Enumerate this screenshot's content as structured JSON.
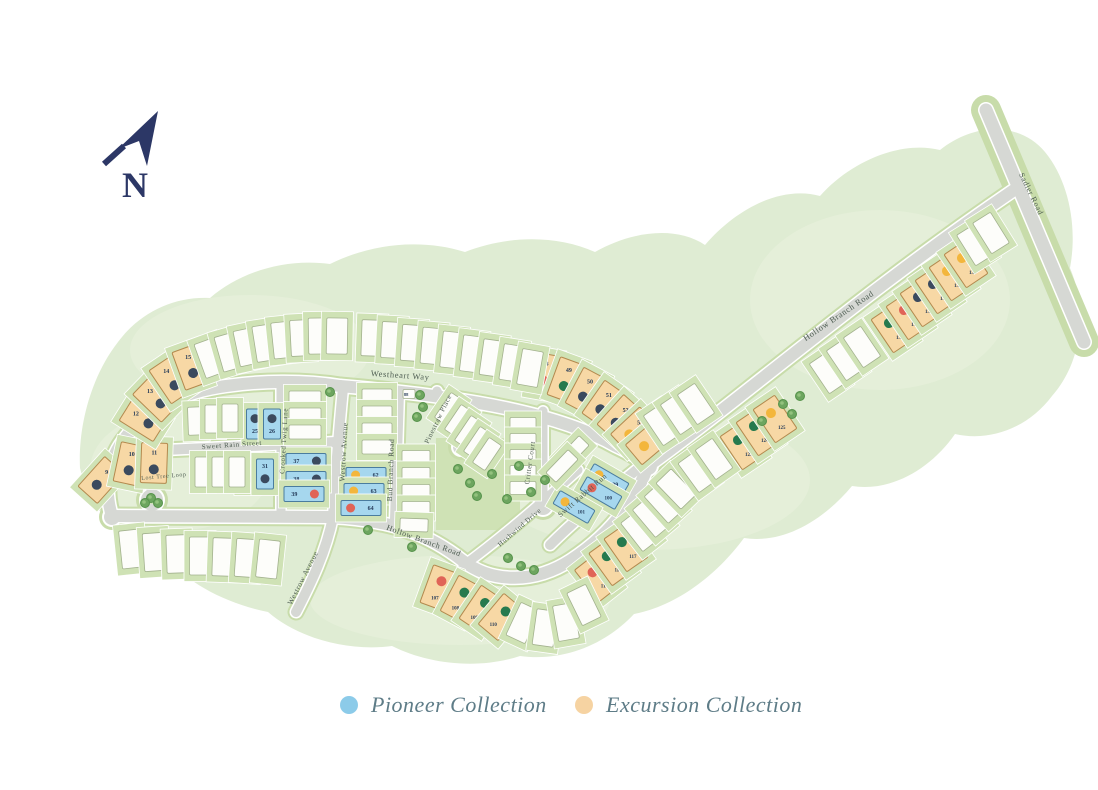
{
  "title": "Community Site Plan",
  "north": {
    "label": "N"
  },
  "legend": {
    "items": [
      {
        "label": "Pioneer Collection",
        "color": "#8ccbe9"
      },
      {
        "label": "Excursion Collection",
        "color": "#f6d3a2"
      }
    ]
  },
  "map": {
    "colors": {
      "blob": "#dfecd3",
      "blob_light": "#e9f3de",
      "verge": "#c8dcaa",
      "road": "#d6d8d4",
      "road_edge": "#ffffff",
      "yard": "#cfe2b5",
      "yard_stroke": "#ffffff",
      "lot_white": "#fdfdfa",
      "lot_white_stroke": "#a3b28e",
      "pioneer": "#a6d7ee",
      "pioneer_stroke": "#4a7c9e",
      "excursion": "#f7d8a5",
      "excursion_stroke": "#b3894e",
      "num": "#243a58",
      "street_text": "#4e5d52",
      "tree_outer": "#6da55f",
      "tree_inner": "#93c27e",
      "tree_stroke": "#55924a",
      "north": "#2c3766",
      "dots": {
        "navy": "#3b4a5e",
        "green": "#267a4e",
        "red": "#e06457",
        "yellow": "#f3b63c"
      }
    },
    "blob": "M80,468 C78,428 90,378 118,342 C140,312 175,296 210,298 C240,272 285,258 330,264 C370,244 420,238 465,252 C505,236 555,234 595,252 C630,232 675,225 705,245 C735,210 780,185 820,196 C850,162 900,140 940,150 C975,122 1020,122 1045,152 C1068,180 1078,225 1070,268 C1088,310 1082,362 1052,396 C1028,428 990,442 955,434 C930,470 890,492 852,486 C822,522 782,544 744,538 C716,576 676,606 634,614 C606,644 564,662 520,656 C478,670 428,664 392,646 C348,652 298,638 268,612 C228,604 188,584 168,558 C128,548 92,516 80,468 Z",
    "patches": [
      [
        250,
        350,
        120,
        55
      ],
      [
        650,
        480,
        160,
        70
      ],
      [
        880,
        300,
        130,
        90
      ],
      [
        460,
        600,
        150,
        45
      ],
      [
        180,
        470,
        90,
        60
      ]
    ],
    "panels": [
      [
        436,
        438,
        84,
        92
      ]
    ],
    "roads": [
      {
        "n": "outer-west",
        "d": "M112,516 C103,487 109,457 126,437 C147,409 182,392 226,386 C260,381 302,380 340,386",
        "w": 12
      },
      {
        "n": "westheart-way",
        "d": "M340,386 C470,397 560,414 616,446 C631,453 641,459 648,466",
        "w": 12
      },
      {
        "n": "hollow-branch-ne",
        "d": "M648,466 C740,400 860,295 1014,190",
        "w": 12
      },
      {
        "n": "sadler-road",
        "d": "M986,110 L1084,342",
        "w": 13,
        "c": 30
      },
      {
        "n": "hollow-branch-s",
        "d": "M112,516 L330,517 C396,520 431,536 463,561 C493,584 536,583 571,560 C606,537 633,506 648,466",
        "w": 12
      },
      {
        "n": "sweet-rain-street",
        "d": "M165,450 L336,442",
        "w": 10
      },
      {
        "n": "lost-tree-loop",
        "d": "M165,450 C153,461 149,476 151,490",
        "w": 9
      },
      {
        "n": "crooked-twig-lane",
        "d": "M281,384 L281,517",
        "w": 9
      },
      {
        "n": "westrow-avenue",
        "d": "M343,388 C338,440 335,480 333,517 C326,552 311,583 296,612",
        "w": 10
      },
      {
        "n": "bud-branch-road",
        "d": "M399,392 L395,520",
        "w": 10
      },
      {
        "n": "pinestraw-place",
        "d": "M437,391 L458,438",
        "w": 9
      },
      {
        "n": "critter-court",
        "d": "M543,411 L543,498",
        "w": 9
      },
      {
        "n": "swift-rabbit-run",
        "d": "M645,463 C612,490 578,517 550,545",
        "w": 10
      },
      {
        "n": "hushwind-drive",
        "d": "M463,566 C505,535 545,500 578,470",
        "w": 9
      }
    ],
    "bulbs": [
      [
        152,
        500,
        11
      ],
      [
        461,
        447,
        8
      ],
      [
        543,
        506,
        9
      ],
      [
        112,
        517,
        8
      ],
      [
        648,
        466,
        9
      ]
    ],
    "streets": [
      {
        "name": "Westheart Way",
        "x": 400,
        "y": 378,
        "r": 4,
        "s": 8.5
      },
      {
        "name": "Sweet Rain Street",
        "x": 232,
        "y": 447,
        "r": -4,
        "s": 7
      },
      {
        "name": "Lost Tree Loop",
        "x": 164,
        "y": 478,
        "r": -5,
        "s": 6
      },
      {
        "name": "Crooked Twig Lane",
        "x": 286,
        "y": 441,
        "r": -87,
        "s": 7
      },
      {
        "name": "Westrow Avenue",
        "x": 346,
        "y": 452,
        "r": -87,
        "s": 7.5
      },
      {
        "name": "Westrow Avenue",
        "x": 305,
        "y": 579,
        "r": -63,
        "s": 7.5
      },
      {
        "name": "Bud Branch Road",
        "x": 393,
        "y": 470,
        "r": -88,
        "s": 7.5
      },
      {
        "name": "Pinestraw Place",
        "x": 440,
        "y": 420,
        "r": -64,
        "s": 7
      },
      {
        "name": "Critter Court",
        "x": 532,
        "y": 463,
        "r": -82,
        "s": 7
      },
      {
        "name": "Swift Rabbit Run",
        "x": 584,
        "y": 497,
        "r": -41,
        "s": 7.5
      },
      {
        "name": "Hushwind Drive",
        "x": 521,
        "y": 529,
        "r": -41,
        "s": 7
      },
      {
        "name": "Hollow Branch Road",
        "x": 423,
        "y": 543,
        "r": 20,
        "s": 8
      },
      {
        "name": "Hollow Branch Road",
        "x": 840,
        "y": 318,
        "r": -34,
        "s": 8.5
      },
      {
        "name": "Sadler Road",
        "x": 1029,
        "y": 195,
        "r": 64,
        "s": 8
      }
    ],
    "trees": [
      [
        330,
        392
      ],
      [
        420,
        395
      ],
      [
        423,
        407
      ],
      [
        417,
        417
      ],
      [
        151,
        498
      ],
      [
        158,
        503
      ],
      [
        145,
        503
      ],
      [
        458,
        469
      ],
      [
        470,
        483
      ],
      [
        492,
        474
      ],
      [
        519,
        466
      ],
      [
        545,
        480
      ],
      [
        531,
        492
      ],
      [
        507,
        499
      ],
      [
        477,
        496
      ],
      [
        368,
        530
      ],
      [
        412,
        547
      ],
      [
        508,
        558
      ],
      [
        521,
        566
      ],
      [
        534,
        570
      ],
      [
        783,
        404
      ],
      [
        792,
        414
      ],
      [
        800,
        396
      ],
      [
        762,
        421
      ]
    ],
    "lots": [
      {
        "n": "9",
        "t": "e",
        "d": "navy",
        "x": 101,
        "y": 480,
        "r": 42
      },
      {
        "n": "10",
        "t": "e",
        "d": "navy",
        "x": 130,
        "y": 464,
        "r": 12
      },
      {
        "n": "11",
        "t": "e",
        "d": "navy",
        "x": 154,
        "y": 463,
        "r": 2
      },
      {
        "n": "12",
        "t": "e",
        "d": "navy",
        "x": 143,
        "y": 420,
        "r": -58
      },
      {
        "n": "13",
        "t": "e",
        "d": "navy",
        "x": 156,
        "y": 399,
        "r": -46
      },
      {
        "n": "14",
        "t": "e",
        "d": "navy",
        "x": 171,
        "y": 380,
        "r": -34
      },
      {
        "n": "15",
        "t": "e",
        "d": "navy",
        "x": 191,
        "y": 367,
        "r": -20
      },
      {
        "n": "25",
        "t": "p",
        "d": "navy",
        "x": 255,
        "y": 424,
        "f": 1
      },
      {
        "n": "26",
        "t": "p",
        "d": "navy",
        "x": 272,
        "y": 424,
        "f": 1
      },
      {
        "n": "30",
        "t": "p",
        "d": "navy",
        "x": 248,
        "y": 474
      },
      {
        "n": "31",
        "t": "p",
        "d": "navy",
        "x": 265,
        "y": 474
      },
      {
        "n": "37",
        "t": "p",
        "s": "l",
        "d": "navy",
        "x": 306,
        "y": 461
      },
      {
        "n": "38",
        "t": "p",
        "s": "l",
        "d": "navy",
        "x": 306,
        "y": 479
      },
      {
        "n": "39",
        "t": "p",
        "s": "l",
        "d": "red",
        "x": 304,
        "y": 494
      },
      {
        "n": "48",
        "t": "e",
        "d": "red",
        "x": 544,
        "y": 374,
        "r": 10
      },
      {
        "n": "49",
        "t": "e",
        "d": "green",
        "x": 566,
        "y": 380,
        "r": 20
      },
      {
        "n": "50",
        "t": "e",
        "d": "navy",
        "x": 586,
        "y": 391,
        "r": 28
      },
      {
        "n": "51",
        "t": "e",
        "d": "navy",
        "x": 604,
        "y": 404,
        "r": 35
      },
      {
        "n": "52",
        "t": "e",
        "d": "navy",
        "x": 620,
        "y": 418,
        "r": 42
      },
      {
        "n": "53",
        "t": "e",
        "d": "yellow",
        "x": 634,
        "y": 430,
        "r": 47
      },
      {
        "n": "54",
        "t": "e",
        "d": "yellow",
        "x": 649,
        "y": 442,
        "r": 50
      },
      {
        "n": "62",
        "t": "p",
        "s": "l",
        "d": "yellow",
        "x": 366,
        "y": 475,
        "f": 1
      },
      {
        "n": "63",
        "t": "p",
        "s": "l",
        "d": "yellow",
        "x": 364,
        "y": 491,
        "f": 1
      },
      {
        "n": "64",
        "t": "p",
        "s": "l",
        "d": "red",
        "x": 361,
        "y": 508,
        "f": 1
      },
      {
        "n": "88",
        "t": "w",
        "x": 409,
        "y": 394,
        "w": 12,
        "h": 9
      },
      {
        "n": "99",
        "t": "p",
        "s": "l",
        "d": "yellow",
        "x": 608,
        "y": 480,
        "r": 30,
        "f": 1
      },
      {
        "n": "100",
        "t": "p",
        "s": "l",
        "d": "red",
        "x": 601,
        "y": 493,
        "r": 30,
        "f": 1
      },
      {
        "n": "101",
        "t": "p",
        "s": "l",
        "d": "yellow",
        "x": 574,
        "y": 507,
        "r": 30,
        "f": 1
      },
      {
        "n": "107",
        "t": "e",
        "d": "red",
        "x": 439,
        "y": 588,
        "r": 20,
        "f": 1
      },
      {
        "n": "108",
        "t": "e",
        "d": "green",
        "x": 461,
        "y": 599,
        "r": 28,
        "f": 1
      },
      {
        "n": "109",
        "t": "e",
        "d": "green",
        "x": 481,
        "y": 609,
        "r": 34,
        "f": 1
      },
      {
        "n": "110",
        "t": "e",
        "d": "green",
        "x": 501,
        "y": 617,
        "r": 40,
        "f": 1
      },
      {
        "n": "115",
        "t": "e",
        "d": "red",
        "x": 597,
        "y": 578,
        "r": -38,
        "f": 1
      },
      {
        "n": "116",
        "t": "e",
        "d": "green",
        "x": 611,
        "y": 562,
        "r": -36,
        "f": 1
      },
      {
        "n": "117",
        "t": "e",
        "d": "green",
        "x": 626,
        "y": 548,
        "r": -35,
        "f": 1
      },
      {
        "n": "123",
        "t": "e",
        "d": "green",
        "x": 742,
        "y": 446,
        "r": -34,
        "f": 1
      },
      {
        "n": "124",
        "t": "e",
        "d": "green",
        "x": 758,
        "y": 432,
        "r": -34,
        "f": 1
      },
      {
        "n": "125",
        "t": "e",
        "d": "yellow",
        "x": 775,
        "y": 419,
        "r": -34,
        "f": 1
      },
      {
        "n": "131",
        "t": "e",
        "d": "green",
        "x": 893,
        "y": 329,
        "r": -34,
        "f": 1
      },
      {
        "n": "132",
        "t": "e",
        "d": "red",
        "x": 908,
        "y": 316,
        "r": -34,
        "f": 1
      },
      {
        "n": "133",
        "t": "e",
        "d": "navy",
        "x": 922,
        "y": 303,
        "r": -34,
        "f": 1
      },
      {
        "n": "134",
        "t": "e",
        "d": "navy",
        "x": 937,
        "y": 290,
        "r": -34,
        "f": 1
      },
      {
        "n": "135",
        "t": "e",
        "d": "yellow",
        "x": 951,
        "y": 277,
        "r": -34,
        "f": 1
      },
      {
        "n": "136",
        "t": "e",
        "d": "yellow",
        "x": 966,
        "y": 264,
        "r": -34,
        "f": 1
      },
      {
        "t": "w",
        "x": 210,
        "y": 358,
        "r": -20
      },
      {
        "t": "w",
        "x": 229,
        "y": 352,
        "r": -16
      },
      {
        "t": "w",
        "x": 247,
        "y": 347,
        "r": -12
      },
      {
        "t": "w",
        "x": 265,
        "y": 343,
        "r": -9
      },
      {
        "t": "w",
        "x": 283,
        "y": 340,
        "r": -6
      },
      {
        "t": "w",
        "x": 301,
        "y": 338,
        "r": -3
      },
      {
        "t": "w",
        "x": 319,
        "y": 336,
        "r": -1
      },
      {
        "t": "w",
        "x": 337,
        "y": 336,
        "r": 1
      },
      {
        "t": "w",
        "x": 372,
        "y": 338,
        "r": 2
      },
      {
        "t": "w",
        "x": 392,
        "y": 340,
        "r": 3
      },
      {
        "t": "w",
        "x": 412,
        "y": 343,
        "r": 4
      },
      {
        "t": "w",
        "x": 432,
        "y": 346,
        "r": 5
      },
      {
        "t": "w",
        "x": 452,
        "y": 350,
        "r": 6
      },
      {
        "t": "w",
        "x": 472,
        "y": 354,
        "r": 7
      },
      {
        "t": "w",
        "x": 492,
        "y": 358,
        "r": 8
      },
      {
        "t": "w",
        "x": 512,
        "y": 363,
        "r": 9
      },
      {
        "t": "w",
        "x": 530,
        "y": 368,
        "r": 10
      },
      {
        "t": "w",
        "x": 196,
        "y": 421,
        "r": -2,
        "w": 16,
        "h": 28
      },
      {
        "t": "w",
        "x": 213,
        "y": 419,
        "w": 16,
        "h": 28
      },
      {
        "t": "w",
        "x": 230,
        "y": 418,
        "w": 16,
        "h": 28
      },
      {
        "t": "w",
        "x": 203,
        "y": 472,
        "w": 16,
        "h": 30
      },
      {
        "t": "w",
        "x": 220,
        "y": 472,
        "w": 16,
        "h": 30
      },
      {
        "t": "w",
        "x": 237,
        "y": 472,
        "w": 16,
        "h": 30
      },
      {
        "t": "w",
        "x": 305,
        "y": 398,
        "w": 32,
        "h": 14
      },
      {
        "t": "w",
        "x": 305,
        "y": 415,
        "w": 32,
        "h": 14
      },
      {
        "t": "w",
        "x": 305,
        "y": 432,
        "w": 32,
        "h": 14
      },
      {
        "t": "w",
        "x": 377,
        "y": 396,
        "w": 30,
        "h": 14
      },
      {
        "t": "w",
        "x": 377,
        "y": 413,
        "w": 30,
        "h": 14
      },
      {
        "t": "w",
        "x": 377,
        "y": 430,
        "w": 30,
        "h": 14
      },
      {
        "t": "w",
        "x": 377,
        "y": 447,
        "w": 30,
        "h": 14
      },
      {
        "t": "w",
        "x": 416,
        "y": 457,
        "w": 28,
        "h": 13
      },
      {
        "t": "w",
        "x": 416,
        "y": 474,
        "w": 28,
        "h": 13
      },
      {
        "t": "w",
        "x": 416,
        "y": 491,
        "w": 28,
        "h": 13
      },
      {
        "t": "w",
        "x": 416,
        "y": 508,
        "w": 28,
        "h": 13
      },
      {
        "t": "w",
        "x": 414,
        "y": 525,
        "r": 2,
        "w": 28,
        "h": 13
      },
      {
        "t": "w",
        "x": 449,
        "y": 409,
        "r": -56,
        "w": 30,
        "h": 15
      },
      {
        "t": "w",
        "x": 459,
        "y": 421,
        "r": -56,
        "w": 30,
        "h": 15
      },
      {
        "t": "w",
        "x": 469,
        "y": 432,
        "r": -56,
        "w": 30,
        "h": 15
      },
      {
        "t": "w",
        "x": 478,
        "y": 443,
        "r": -56,
        "w": 30,
        "h": 15
      },
      {
        "t": "w",
        "x": 487,
        "y": 454,
        "r": -56,
        "w": 30,
        "h": 15
      },
      {
        "t": "w",
        "x": 523,
        "y": 424,
        "w": 26,
        "h": 13
      },
      {
        "t": "w",
        "x": 523,
        "y": 440,
        "w": 26,
        "h": 13
      },
      {
        "t": "w",
        "x": 523,
        "y": 456,
        "w": 26,
        "h": 13
      },
      {
        "t": "w",
        "x": 523,
        "y": 472,
        "w": 26,
        "h": 13
      },
      {
        "t": "w",
        "x": 523,
        "y": 488,
        "w": 26,
        "h": 13
      },
      {
        "t": "w",
        "x": 573,
        "y": 452,
        "r": -46,
        "w": 32,
        "h": 14
      },
      {
        "t": "w",
        "x": 562,
        "y": 466,
        "r": -46,
        "w": 32,
        "h": 14
      },
      {
        "t": "w",
        "x": 640,
        "y": 531,
        "r": -38
      },
      {
        "t": "w",
        "x": 652,
        "y": 517,
        "r": -40
      },
      {
        "t": "w",
        "x": 664,
        "y": 503,
        "r": -42
      },
      {
        "t": "w",
        "x": 676,
        "y": 489,
        "r": -44
      },
      {
        "t": "w",
        "x": 662,
        "y": 425,
        "r": -34
      },
      {
        "t": "w",
        "x": 679,
        "y": 414,
        "r": -34
      },
      {
        "t": "w",
        "x": 696,
        "y": 404,
        "r": -34
      },
      {
        "t": "w",
        "x": 697,
        "y": 472,
        "r": -36
      },
      {
        "t": "w",
        "x": 714,
        "y": 459,
        "r": -35
      },
      {
        "t": "w",
        "x": 828,
        "y": 373,
        "r": -34
      },
      {
        "t": "w",
        "x": 845,
        "y": 360,
        "r": -34
      },
      {
        "t": "w",
        "x": 862,
        "y": 347,
        "r": -34
      },
      {
        "t": "w",
        "x": 975,
        "y": 245,
        "r": -32
      },
      {
        "t": "w",
        "x": 991,
        "y": 233,
        "r": -32
      },
      {
        "t": "w",
        "x": 131,
        "y": 549,
        "r": -6,
        "w": 21,
        "h": 38
      },
      {
        "t": "w",
        "x": 154,
        "y": 552,
        "r": -4,
        "w": 21,
        "h": 38
      },
      {
        "t": "w",
        "x": 177,
        "y": 554,
        "r": -2,
        "w": 21,
        "h": 38
      },
      {
        "t": "w",
        "x": 200,
        "y": 556,
        "w": 21,
        "h": 38
      },
      {
        "t": "w",
        "x": 223,
        "y": 557,
        "r": 2,
        "w": 21,
        "h": 38
      },
      {
        "t": "w",
        "x": 246,
        "y": 558,
        "r": 4,
        "w": 21,
        "h": 38
      },
      {
        "t": "w",
        "x": 268,
        "y": 559,
        "r": 6,
        "w": 21,
        "h": 38
      },
      {
        "t": "w",
        "x": 523,
        "y": 623,
        "r": 25
      },
      {
        "t": "w",
        "x": 545,
        "y": 628,
        "r": 8
      },
      {
        "t": "w",
        "x": 566,
        "y": 622,
        "r": -10
      },
      {
        "t": "w",
        "x": 584,
        "y": 605,
        "r": -26
      }
    ]
  }
}
